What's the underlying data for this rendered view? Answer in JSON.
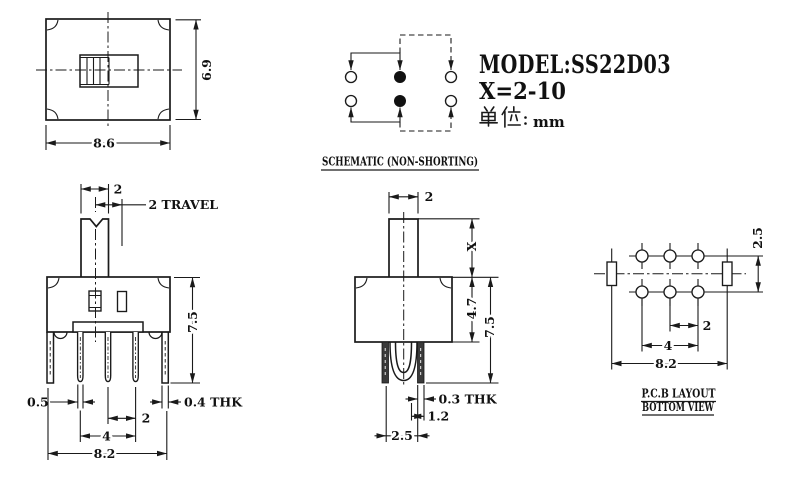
{
  "title": {
    "model": "MODEL:SS22D03",
    "range": "X=2-10",
    "unit_prefix": "单位",
    "unit_colon": "：",
    "unit_value": "mm"
  },
  "labels": {
    "schematic": "SCHEMATIC (NON-SHORTING)",
    "pcb_line1": "P.C.B LAYOUT",
    "pcb_line2": "BOTTOM VIEW"
  },
  "dims": {
    "top": {
      "width": "8.6",
      "height": "6.9"
    },
    "front": {
      "knob_width": "2",
      "travel": "2 TRAVEL",
      "height": "7.5",
      "terminal_width": "0.5",
      "bracket_thk": "0.4 THK",
      "pitch": "2",
      "span": "4",
      "width": "8.2"
    },
    "side": {
      "knob_depth": "2",
      "stem_height": "X",
      "body_depth": "4.7",
      "height": "7.5",
      "pin_thk": "0.3 THK",
      "pin_offset": "1.2",
      "pin_span": "2.5"
    },
    "pcb": {
      "row_spacing": "2.5",
      "pitch": "2",
      "span": "4",
      "width": "8.2"
    }
  },
  "colors": {
    "line": "#1a1a1a",
    "bg": "#ffffff"
  }
}
